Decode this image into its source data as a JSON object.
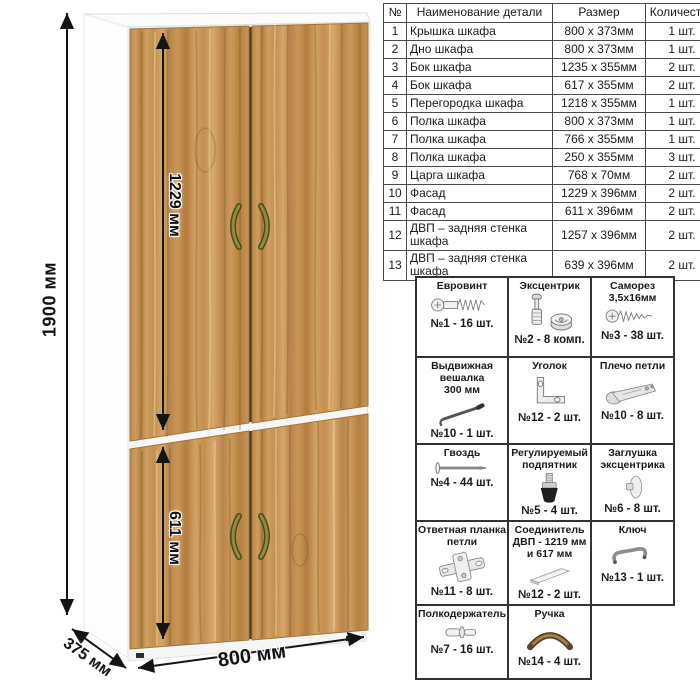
{
  "dims": {
    "height": "1900 мм",
    "upper_door": "1229 мм",
    "lower_door": "611 мм",
    "width": "800 мм",
    "depth": "375 мм"
  },
  "colors": {
    "wood": "#c6924f",
    "handle_bronze": "#8f8d3d",
    "dimension_line": "#141414",
    "table_border": "#444444"
  },
  "parts_table": {
    "headers": {
      "num": "№",
      "name": "Наименование детали",
      "size": "Размер",
      "qty": "Количество"
    },
    "rows": [
      {
        "num": "1",
        "name": "Крышка шкафа",
        "size": "800 x 373мм",
        "qty": "1 шт."
      },
      {
        "num": "2",
        "name": "Дно шкафа",
        "size": "800 x 373мм",
        "qty": "1 шт."
      },
      {
        "num": "3",
        "name": "Бок шкафа",
        "size": "1235 x 355мм",
        "qty": "2 шт."
      },
      {
        "num": "4",
        "name": "Бок шкафа",
        "size": "617 x 355мм",
        "qty": "2 шт."
      },
      {
        "num": "5",
        "name": "Перегородка шкафа",
        "size": "1218 x 355мм",
        "qty": "1 шт."
      },
      {
        "num": "6",
        "name": "Полка шкафа",
        "size": "800 x 373мм",
        "qty": "1 шт."
      },
      {
        "num": "7",
        "name": "Полка шкафа",
        "size": "766 x 355мм",
        "qty": "1 шт."
      },
      {
        "num": "8",
        "name": "Полка шкафа",
        "size": "250 x 355мм",
        "qty": "3 шт."
      },
      {
        "num": "9",
        "name": "Царга шкафа",
        "size": "768 x 70мм",
        "qty": "2 шт."
      },
      {
        "num": "10",
        "name": "Фасад",
        "size": "1229 x 396мм",
        "qty": "2 шт."
      },
      {
        "num": "11",
        "name": "Фасад",
        "size": "611 x 396мм",
        "qty": "2 шт."
      },
      {
        "num": "12",
        "name": "ДВП – задняя стенка шкафа",
        "size": "1257 x 396мм",
        "qty": "2 шт."
      },
      {
        "num": "13",
        "name": "ДВП – задняя стенка шкафа",
        "size": "639 x 396мм",
        "qty": "2 шт."
      }
    ]
  },
  "hardware": {
    "items": [
      {
        "title": "Евровинт",
        "icon": "euro-screw",
        "count": "№1 - 16 шт."
      },
      {
        "title": "Эксцентрик",
        "icon": "eccentric-cam",
        "count": "№2 - 8 комп."
      },
      {
        "title": "Саморез\n3,5x16мм",
        "icon": "small-screw",
        "count": "№3 - 38 шт."
      },
      {
        "title": "Выдвижная\nвешалка\n300 мм",
        "icon": "pullout-hanger",
        "count": "№10 - 1 шт."
      },
      {
        "title": "Уголок",
        "icon": "corner-bracket",
        "count": "№12 - 2 шт."
      },
      {
        "title": "Плечо петли",
        "icon": "hinge-arm",
        "count": "№10 - 8 шт."
      },
      {
        "title": "Гвоздь",
        "icon": "nail",
        "count": "№4 - 44 шт."
      },
      {
        "title": "Регулируемый\nподпятник",
        "icon": "adjustable-foot",
        "count": "№5 - 4 шт."
      },
      {
        "title": "Заглушка\nэксцентрика",
        "icon": "cam-cover",
        "count": "№6 - 8 шт."
      },
      {
        "title": "Ответная планка\nпетли",
        "icon": "hinge-plate",
        "count": "№11 - 8 шт."
      },
      {
        "title": "Соединитель\nДВП - 1219 мм\nи 617 мм",
        "icon": "hdf-connector",
        "count": "№12 - 2 шт."
      },
      {
        "title": "Ключ",
        "icon": "key",
        "count": "№13 - 1 шт."
      },
      {
        "title": "Полкодержатель",
        "icon": "shelf-pin",
        "count": "№7 - 16 шт."
      },
      {
        "title": "Ручка",
        "icon": "handle",
        "count": "№14 - 4 шт."
      }
    ]
  }
}
